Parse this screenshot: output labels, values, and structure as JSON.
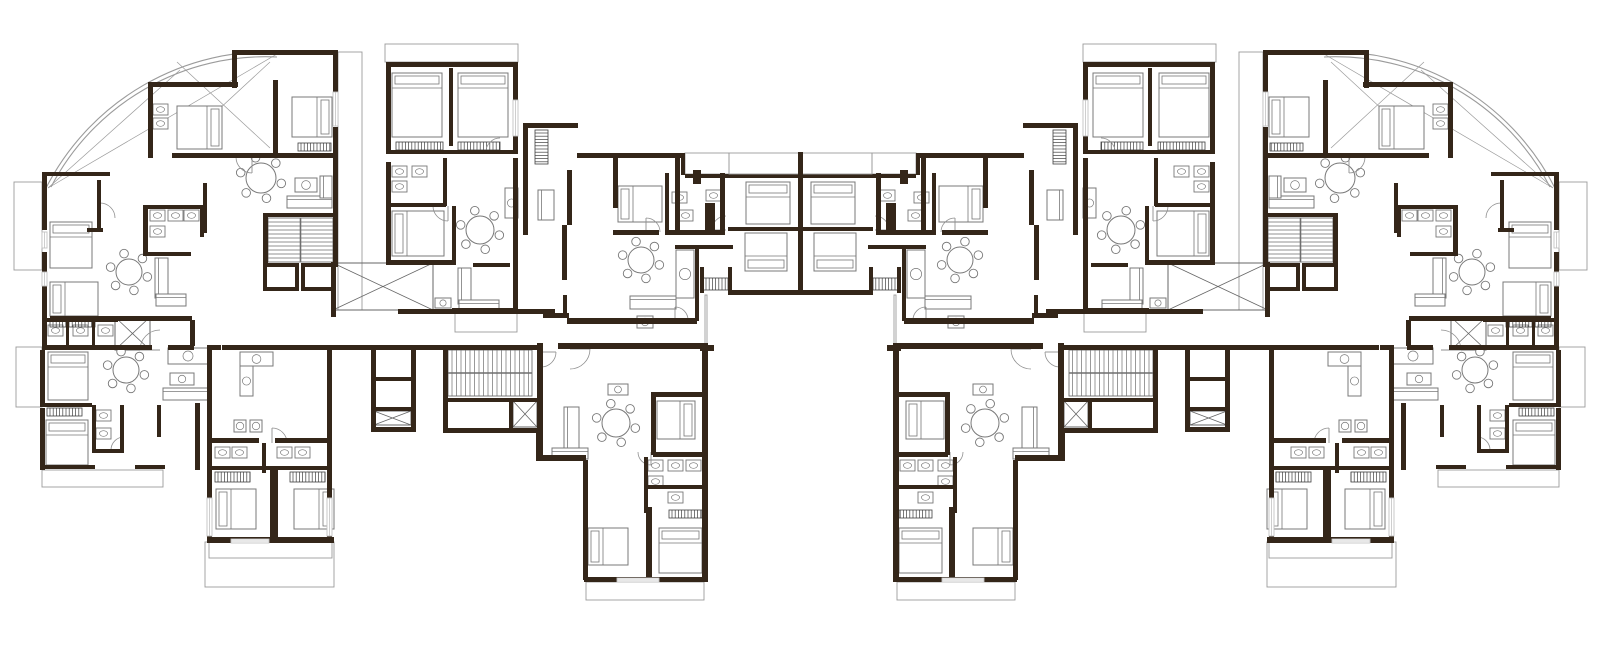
{
  "meta": {
    "viewBox": "0 0 1600 645",
    "canvas": {
      "w": 1600,
      "h": 645
    },
    "mirror_axis_x": 800.5,
    "colors": {
      "background": "#ffffff",
      "wall": "#342619",
      "furniture": "#787878",
      "thin": "#9b9b9b",
      "hatch": "#3f3f3f",
      "stair": "#6e6e6e",
      "door": "#8f8f8f",
      "window": "#c2c2c2"
    },
    "icon_names": [
      "bed-icon",
      "dining-table-icon",
      "sofa-icon",
      "bath-fixture-icon",
      "kitchen-counter-icon",
      "wardrobe-hatch-icon",
      "stair-icon",
      "elevator-xbox-icon",
      "door-arc-icon",
      "window-icon",
      "fan-terrace-arc"
    ]
  },
  "plan": {
    "walls": [
      [
        232,
        50,
        106,
        5
      ],
      [
        232,
        50,
        5,
        38
      ],
      [
        333,
        50,
        5,
        45
      ],
      [
        333,
        127,
        5,
        140
      ],
      [
        273,
        80,
        5,
        78
      ],
      [
        148,
        82,
        90,
        5
      ],
      [
        148,
        82,
        5,
        76
      ],
      [
        172,
        153,
        165,
        5
      ],
      [
        42,
        172,
        68,
        4
      ],
      [
        42,
        172,
        5,
        58
      ],
      [
        97,
        180,
        4,
        50
      ],
      [
        42,
        252,
        5,
        66
      ],
      [
        87,
        228,
        16,
        4
      ],
      [
        143,
        205,
        62,
        4
      ],
      [
        143,
        205,
        5,
        50
      ],
      [
        200,
        205,
        4,
        32
      ],
      [
        143,
        252,
        48,
        4
      ],
      [
        203,
        183,
        4,
        50
      ],
      [
        50,
        316,
        142,
        5
      ],
      [
        190,
        320,
        5,
        26
      ],
      [
        263,
        213,
        74,
        4
      ],
      [
        263,
        217,
        5,
        50
      ],
      [
        386,
        62,
        132,
        5
      ],
      [
        386,
        62,
        5,
        88
      ],
      [
        513,
        62,
        5,
        88
      ],
      [
        449,
        68,
        4,
        78
      ],
      [
        386,
        150,
        132,
        4
      ],
      [
        386,
        162,
        5,
        102
      ],
      [
        443,
        158,
        4,
        48
      ],
      [
        386,
        203,
        60,
        4
      ],
      [
        452,
        206,
        4,
        56
      ],
      [
        386,
        260,
        70,
        5
      ],
      [
        513,
        158,
        5,
        155
      ],
      [
        452,
        308,
        63,
        5
      ],
      [
        523,
        123,
        55,
        5
      ],
      [
        523,
        123,
        5,
        112
      ],
      [
        562,
        225,
        5,
        55
      ],
      [
        567,
        170,
        5,
        55
      ],
      [
        543,
        313,
        26,
        5
      ],
      [
        563,
        295,
        4,
        23
      ],
      [
        577,
        153,
        108,
        5
      ],
      [
        681,
        153,
        4,
        22
      ],
      [
        685,
        174,
        45,
        4
      ],
      [
        728,
        174,
        75,
        4
      ],
      [
        613,
        158,
        5,
        50
      ],
      [
        675,
        158,
        5,
        77
      ],
      [
        613,
        230,
        46,
        5
      ],
      [
        665,
        173,
        4,
        60
      ],
      [
        665,
        230,
        60,
        5
      ],
      [
        720,
        173,
        5,
        62
      ],
      [
        693,
        170,
        8,
        14
      ],
      [
        705,
        203,
        10,
        28
      ],
      [
        728,
        227,
        74,
        4
      ],
      [
        700,
        267,
        4,
        26
      ],
      [
        728,
        267,
        4,
        26
      ],
      [
        728,
        290,
        76,
        5
      ],
      [
        675,
        245,
        58,
        4
      ],
      [
        695,
        249,
        4,
        72
      ],
      [
        567,
        318,
        130,
        6
      ],
      [
        700,
        345,
        14,
        6
      ],
      [
        330,
        345,
        43,
        5
      ],
      [
        416,
        345,
        27,
        5
      ],
      [
        371,
        345,
        45,
        5
      ],
      [
        371,
        345,
        5,
        86
      ],
      [
        411,
        345,
        5,
        86
      ],
      [
        373,
        377,
        40,
        4
      ],
      [
        373,
        407,
        40,
        4
      ],
      [
        371,
        427,
        45,
        5
      ],
      [
        443,
        345,
        99,
        5
      ],
      [
        443,
        345,
        5,
        88
      ],
      [
        537,
        345,
        5,
        88
      ],
      [
        443,
        428,
        99,
        5
      ],
      [
        445,
        398,
        94,
        4
      ],
      [
        509,
        400,
        4,
        28
      ],
      [
        536,
        430,
        5,
        28
      ],
      [
        331,
        262,
        5,
        55
      ],
      [
        398,
        309,
        157,
        5
      ],
      [
        473,
        263,
        37,
        4
      ],
      [
        211,
        345,
        10,
        5
      ],
      [
        222,
        345,
        110,
        5
      ],
      [
        207,
        345,
        5,
        133
      ],
      [
        327,
        350,
        5,
        128
      ],
      [
        207,
        438,
        52,
        5
      ],
      [
        275,
        438,
        57,
        5
      ],
      [
        262,
        443,
        4,
        30
      ],
      [
        212,
        466,
        115,
        4
      ],
      [
        270,
        470,
        8,
        72
      ],
      [
        207,
        478,
        5,
        64
      ],
      [
        327,
        478,
        5,
        64
      ],
      [
        207,
        537,
        127,
        6
      ],
      [
        537,
        343,
        6,
        114
      ],
      [
        558,
        343,
        150,
        6
      ],
      [
        536,
        455,
        50,
        6
      ],
      [
        583,
        460,
        5,
        120
      ],
      [
        702,
        350,
        6,
        232
      ],
      [
        653,
        392,
        53,
        5
      ],
      [
        651,
        392,
        5,
        63
      ],
      [
        653,
        452,
        53,
        5
      ],
      [
        644,
        457,
        4,
        56
      ],
      [
        644,
        485,
        60,
        4
      ],
      [
        646,
        507,
        6,
        73
      ],
      [
        584,
        577,
        122,
        5
      ],
      [
        42,
        318,
        76,
        4
      ],
      [
        66,
        318,
        3,
        29
      ],
      [
        92,
        318,
        3,
        29
      ],
      [
        42,
        322,
        5,
        25
      ],
      [
        42,
        345,
        110,
        5
      ],
      [
        168,
        345,
        26,
        5
      ],
      [
        40,
        350,
        5,
        57
      ],
      [
        42,
        403,
        50,
        4
      ],
      [
        40,
        408,
        5,
        62
      ],
      [
        42,
        465,
        53,
        4
      ],
      [
        92,
        405,
        4,
        48
      ],
      [
        120,
        405,
        4,
        48
      ],
      [
        92,
        449,
        32,
        4
      ],
      [
        135,
        465,
        30,
        4
      ],
      [
        157,
        405,
        4,
        32
      ],
      [
        195,
        403,
        5,
        67
      ]
    ],
    "walls_center": [
      [
        798,
        152,
        5,
        142
      ]
    ],
    "thin_rects": [
      [
        14,
        182,
        28,
        88
      ],
      [
        16,
        347,
        26,
        60
      ],
      [
        385,
        44,
        133,
        18
      ],
      [
        338,
        52,
        24,
        258
      ],
      [
        455,
        313,
        62,
        19
      ],
      [
        42,
        470,
        121,
        17
      ],
      [
        205,
        542,
        129,
        45
      ],
      [
        209,
        542,
        123,
        16
      ],
      [
        586,
        582,
        118,
        18
      ],
      [
        685,
        153,
        44,
        21
      ],
      [
        705,
        295,
        2,
        50
      ]
    ],
    "thin_rects_center": [
      [
        729,
        153,
        143,
        21
      ]
    ],
    "xboxes": [
      [
        333,
        263,
        100,
        47
      ],
      [
        115,
        317,
        35,
        33
      ],
      [
        374,
        411,
        37,
        14
      ],
      [
        513,
        401,
        24,
        26
      ]
    ],
    "landings": [
      [
        263,
        263,
        36,
        28
      ],
      [
        301,
        263,
        34,
        28
      ]
    ],
    "stairs": [
      {
        "x": 268,
        "y": 218,
        "w": 65,
        "h": 44,
        "orient": "h",
        "divider": "v"
      },
      {
        "x": 448,
        "y": 350,
        "w": 84,
        "h": 46,
        "orient": "v",
        "divider": "h"
      }
    ],
    "beds": [
      [
        177,
        106,
        45,
        43,
        "e"
      ],
      [
        292,
        97,
        40,
        40,
        "e"
      ],
      [
        50,
        222,
        42,
        46,
        "n"
      ],
      [
        50,
        282,
        48,
        34,
        "w"
      ],
      [
        392,
        73,
        50,
        64,
        "n"
      ],
      [
        458,
        73,
        50,
        64,
        "n"
      ],
      [
        392,
        211,
        52,
        45,
        "w"
      ],
      [
        618,
        186,
        44,
        36,
        "w"
      ],
      [
        746,
        182,
        44,
        42,
        "n"
      ],
      [
        745,
        233,
        42,
        38,
        "s"
      ],
      [
        48,
        352,
        40,
        48,
        "n"
      ],
      [
        46,
        420,
        42,
        45,
        "n"
      ],
      [
        216,
        489,
        40,
        40,
        "w"
      ],
      [
        294,
        489,
        40,
        40,
        "e"
      ],
      [
        588,
        528,
        40,
        37,
        "w"
      ],
      [
        659,
        528,
        43,
        45,
        "n"
      ],
      [
        657,
        401,
        38,
        38,
        "e"
      ]
    ],
    "tables": [
      [
        261,
        178,
        15
      ],
      [
        129,
        272,
        13
      ],
      [
        480,
        230,
        14
      ],
      [
        641,
        260,
        13
      ],
      [
        126,
        370,
        13
      ],
      [
        616,
        423,
        14
      ]
    ],
    "sofas": [
      [
        287,
        196,
        45,
        12,
        "h"
      ],
      [
        320,
        176,
        12,
        22,
        "v"
      ],
      [
        155,
        258,
        13,
        40,
        "v"
      ],
      [
        156,
        294,
        30,
        12,
        "h"
      ],
      [
        458,
        268,
        13,
        36,
        "v"
      ],
      [
        459,
        300,
        40,
        12,
        "h"
      ],
      [
        630,
        296,
        46,
        13,
        "h"
      ],
      [
        163,
        388,
        45,
        12,
        "h"
      ],
      [
        564,
        407,
        15,
        44,
        "v"
      ],
      [
        552,
        448,
        36,
        11,
        "h"
      ],
      [
        538,
        190,
        16,
        30,
        "v"
      ]
    ],
    "baths": [
      [
        153,
        104
      ],
      [
        153,
        118
      ],
      [
        150,
        210
      ],
      [
        150,
        226
      ],
      [
        168,
        210
      ],
      [
        184,
        210
      ],
      [
        392,
        166
      ],
      [
        392,
        181
      ],
      [
        412,
        166
      ],
      [
        672,
        192
      ],
      [
        678,
        210
      ],
      [
        706,
        190
      ],
      [
        648,
        460
      ],
      [
        648,
        476
      ],
      [
        668,
        460
      ],
      [
        686,
        460
      ],
      [
        668,
        492
      ],
      [
        48,
        325
      ],
      [
        73,
        325
      ],
      [
        98,
        325
      ],
      [
        96,
        410
      ],
      [
        96,
        428
      ],
      [
        215,
        447
      ],
      [
        232,
        447
      ],
      [
        277,
        447
      ],
      [
        295,
        447
      ]
    ],
    "kitchens": [
      [
        295,
        178,
        22,
        14
      ],
      [
        676,
        250,
        18,
        48
      ],
      [
        505,
        188,
        13,
        30
      ],
      [
        240,
        352,
        33,
        14
      ],
      [
        240,
        366,
        13,
        30
      ],
      [
        168,
        348,
        40,
        16
      ],
      [
        608,
        384,
        20,
        11
      ],
      [
        170,
        373,
        24,
        12
      ],
      [
        234,
        420,
        12,
        12
      ],
      [
        250,
        420,
        12,
        12
      ],
      [
        637,
        316,
        16,
        12
      ],
      [
        435,
        298,
        16,
        10
      ]
    ],
    "hatches": [
      [
        298,
        143,
        33,
        8
      ],
      [
        50,
        320,
        45,
        7
      ],
      [
        396,
        142,
        47,
        8
      ],
      [
        458,
        142,
        42,
        8
      ],
      [
        703,
        278,
        25,
        12
      ],
      [
        47,
        408,
        35,
        8
      ],
      [
        215,
        472,
        35,
        10
      ],
      [
        290,
        472,
        35,
        10
      ],
      [
        669,
        510,
        33,
        8
      ],
      [
        535,
        130,
        13,
        34
      ]
    ],
    "windows": [
      [
        333,
        92,
        5,
        34
      ],
      [
        42,
        232,
        5,
        16
      ],
      [
        42,
        272,
        5,
        14
      ],
      [
        513,
        100,
        5,
        36
      ],
      [
        207,
        498,
        5,
        38
      ],
      [
        327,
        498,
        5,
        38
      ],
      [
        231,
        539,
        38,
        4
      ],
      [
        617,
        578,
        42,
        4
      ]
    ],
    "doors": [
      [
        160,
        350,
        20,
        180,
        270
      ],
      [
        252,
        157,
        16,
        90,
        180
      ],
      [
        100,
        218,
        15,
        270,
        360
      ],
      [
        448,
        206,
        15,
        90,
        180
      ],
      [
        500,
        152,
        14,
        180,
        270
      ],
      [
        646,
        232,
        14,
        270,
        360
      ],
      [
        726,
        230,
        14,
        180,
        270
      ],
      [
        570,
        349,
        20,
        0,
        90
      ],
      [
        651,
        452,
        13,
        90,
        180
      ],
      [
        272,
        443,
        15,
        270,
        360
      ],
      [
        124,
        450,
        13,
        180,
        270
      ],
      [
        541,
        352,
        15,
        0,
        90
      ],
      [
        675,
        320,
        13,
        270,
        360
      ]
    ],
    "fan_arcs": [
      "M283,52 A250,250 0 0 0 45,190",
      "M277,57 A242,242 0 0 0 51,187"
    ],
    "fan_lines": [
      [
        48,
        188,
        277,
        54
      ],
      [
        48,
        188,
        180,
        70
      ],
      [
        177,
        62,
        270,
        148
      ],
      [
        270,
        62,
        177,
        148
      ]
    ]
  }
}
